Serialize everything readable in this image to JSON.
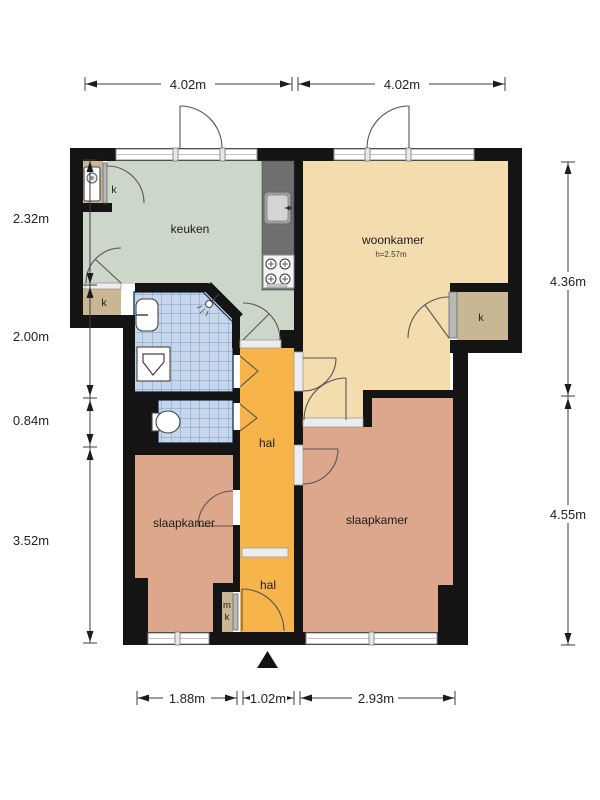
{
  "plan": {
    "rooms": {
      "keuken": {
        "label": "keuken"
      },
      "woonkamer": {
        "label": "woonkamer",
        "ceiling_height": "h=2.57m"
      },
      "hal_top": {
        "label": "hal"
      },
      "hal_bottom": {
        "label": "hal"
      },
      "slaapkamer_left": {
        "label": "slaapkamer"
      },
      "slaapkamer_right": {
        "label": "slaapkamer"
      },
      "closet_top_left": {
        "label": "k"
      },
      "closet_mid_left": {
        "label": "k"
      },
      "closet_right": {
        "label": "k"
      },
      "meter_closet": {
        "line1": "m",
        "line2": "k"
      }
    },
    "dimensions": {
      "top": [
        "4.02m",
        "4.02m"
      ],
      "left": [
        "2.32m",
        "2.00m",
        "0.84m",
        "3.52m"
      ],
      "right": [
        "4.36m",
        "4.55m"
      ],
      "bottom": [
        "1.88m",
        "1.02m",
        "2.93m"
      ]
    },
    "colors": {
      "wall": "#141414",
      "keuken_floor": "#ccd7c9",
      "woonkamer_floor": "#f3ddae",
      "slaapkamer_floor": "#dca78b",
      "hal_floor": "#f6b44a",
      "closet_floor": "#c9b693",
      "tile_fill": "#c6d7ec",
      "tile_grid": "#7d99c0",
      "counter": "#6f6f6f"
    }
  }
}
